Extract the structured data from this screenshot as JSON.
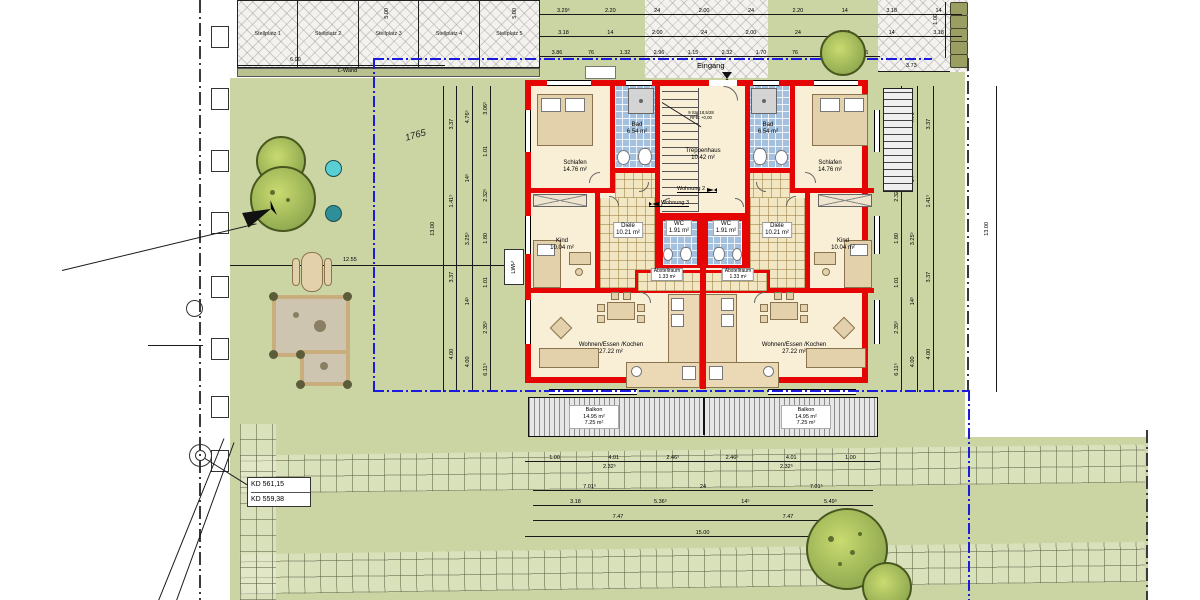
{
  "site": {
    "parcel_number": "1765",
    "entrance_label": "Eingang",
    "l_wall_label": "L-Wand",
    "heat_pump_label": "LWP",
    "elevation_marks": [
      "KD 561,15",
      "KD 559,38"
    ]
  },
  "parking": {
    "stalls": [
      "Stellplatz 1",
      "Stellplatz 2",
      "Stellplatz 3",
      "Stellplatz 4",
      "Stellplatz 5"
    ],
    "depth_label": "5.00",
    "length_label": "6.00"
  },
  "building": {
    "stairwell_note": [
      "9 Stg 18,5/28",
      "RFB: +0,00"
    ],
    "apartment_2": "Wohnung 2",
    "apartment_3": "Wohnung 3",
    "rooms": {
      "schlafen": {
        "name": "Schlafen",
        "area": "14.76 m²"
      },
      "bad": {
        "name": "Bad",
        "area": "6.54 m²"
      },
      "treppenhaus": {
        "name": "Treppenhaus",
        "area": "10.42 m²"
      },
      "diele": {
        "name": "Diele",
        "area": "10.21 m²"
      },
      "wc": {
        "name": "WC",
        "area": "1.91 m²"
      },
      "kind": {
        "name": "Kind",
        "area": "10.04 m²"
      },
      "abstellraum": {
        "name": "Abstellraum",
        "area": "1.33 m²"
      },
      "wohnen": {
        "name": "Wohnen/Essen /Kochen",
        "area": "27.22 m²"
      },
      "balkon": {
        "name": "Balkon",
        "area_total": "14.95 m²",
        "area_counted": "7.25 m²"
      }
    }
  },
  "dimensions": {
    "top_row1": [
      "3.29⁵",
      "2.20",
      "24",
      "2.00",
      "24",
      "2.20",
      "14",
      "3.18",
      "14"
    ],
    "top_row2": [
      "3.18",
      "14",
      "2.00",
      "24",
      "2.00",
      "24",
      "2.00",
      "14",
      "3.18"
    ],
    "top_row3": [
      "3.86",
      "76",
      "1.32",
      "2.96",
      "1.15",
      "2.32",
      "1.70",
      "76",
      "1.32",
      "3.86"
    ],
    "side_outer": [
      "3.37",
      "1.41⁵",
      "3.37",
      "4.00"
    ],
    "side_mid": [
      "4.76⁵",
      "14⁵",
      "3.25⁵",
      "14⁵",
      "4.00"
    ],
    "side_inner": [
      "3.06⁵",
      "1.01",
      "2.32⁵",
      "1.80",
      "1.01",
      "2.35⁵",
      "6.11⁵"
    ],
    "side_total": "13.00",
    "garden_width": "12.55",
    "paved_width": "3.73",
    "bin_row": "1.00",
    "bottom_row1": [
      "1.00",
      "4.01",
      "2.46⁵",
      "2.46⁵",
      "4.01",
      "1.00"
    ],
    "bottom_row1_sub": [
      "2.32⁵",
      "2.32⁵"
    ],
    "bottom_row2": [
      "7.01⁵",
      "24",
      "7.01⁵"
    ],
    "bottom_row3": [
      "3.18",
      "5.36⁵",
      "14⁵",
      "5.49⁵"
    ],
    "bottom_row4": [
      "7.47",
      "7.47"
    ],
    "bottom_total": "15.00"
  },
  "colors": {
    "wall_red": "#e60505",
    "lawn_green": "#cbd5a4",
    "tile_blue": "#a3c1de",
    "utility_blue": "#1b1bdd"
  }
}
